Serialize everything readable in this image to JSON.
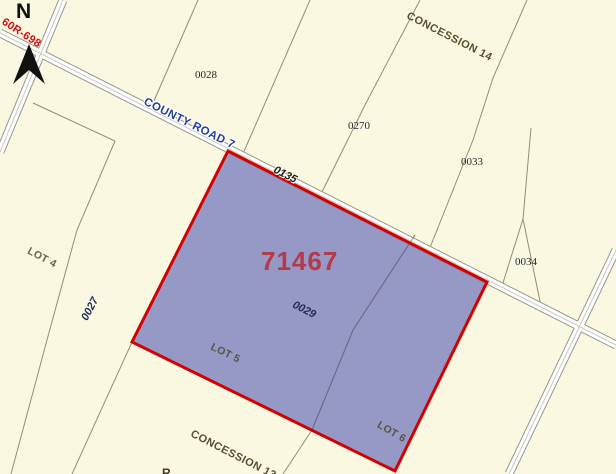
{
  "map": {
    "title": "parcel map with selected property",
    "north_label": "N",
    "plan_number": "60R-698",
    "road": {
      "name": "COUNTY ROAD 7",
      "segment_number": "0135"
    },
    "selected_parcel": {
      "roll_number": "71467",
      "parcel_number": "0029",
      "fill_color": "#9698C5",
      "outline_color": "#D40000"
    },
    "parcel_numbers": {
      "p0028": "0028",
      "p0270": "0270",
      "p0033": "0033",
      "p0034": "0034",
      "p0027": "0027"
    },
    "lots": {
      "lot4": "LOT 4",
      "lot5": "LOT 5",
      "lot6": "LOT 6"
    },
    "concessions": {
      "c14": "CONCESSION 14",
      "c13": "CONCESSION 13"
    },
    "partial_label": "R",
    "colors": {
      "background": "#FBF8E2",
      "lot_line": "#8F8F70",
      "road_casing": "#97978C",
      "road_fill": "#FFFFFF",
      "selected_number_color": "#B23A4A",
      "road_label_color": "#22409B",
      "plan_number_color": "#CC0E0E"
    }
  }
}
